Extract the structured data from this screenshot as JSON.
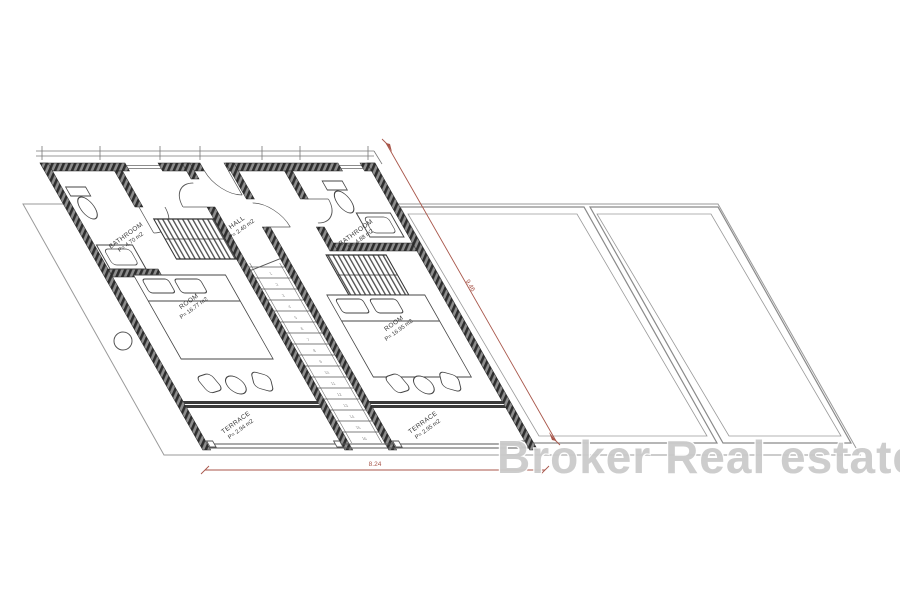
{
  "watermark": {
    "text": "Broker Real estate"
  },
  "plan": {
    "unit1": {
      "bathroom": {
        "name": "BATHROOM",
        "area": "P= 4.70 m2"
      },
      "room": {
        "name": "ROOM",
        "area": "P= 16.77 m2"
      },
      "terrace": {
        "name": "TERRACE",
        "area": "P= 2.94 m2"
      }
    },
    "hall": {
      "name": "HALL",
      "area": "P= 2.40 m2"
    },
    "unit2": {
      "bathroom": {
        "name": "BATHROOM",
        "area": "P= 4.88 m2"
      },
      "room": {
        "name": "ROOM",
        "area": "P= 16.95 m2"
      },
      "terrace": {
        "name": "TERRACE",
        "area": "P= 2.95 m2"
      }
    },
    "stairs": {
      "steps": 16
    }
  },
  "dimensions": {
    "diagonal": "9.46",
    "bottom": "8.24",
    "color": "#a8564a"
  }
}
